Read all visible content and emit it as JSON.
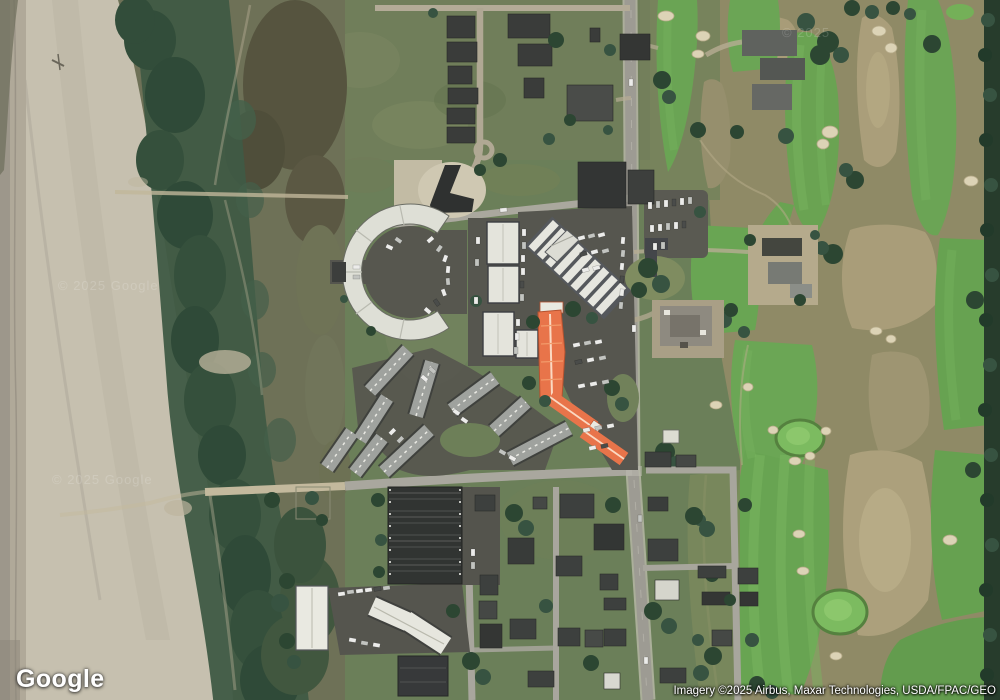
{
  "page": {
    "kind": "satellite map viewport",
    "width_px": 1000,
    "height_px": 700
  },
  "branding": {
    "logo_text": "Google"
  },
  "attribution": {
    "text": "Imagery ©2025 Airbus, Maxar Technologies, USDA/FPAC/GEO"
  },
  "watermarks": {
    "beach_upper": "© 2025 Google",
    "beach_lower": "© 2025 Google",
    "golf": "© 2025"
  },
  "map": {
    "view_type": "satellite imagery, top-down",
    "scene_summary": "Coastal resort strip: ocean beach and vegetated dunes on the west, a small town with condo buildings, motels, storage and parking lots in the center along a north-south main road, and a links golf course with fairways, sand bunkers, waste areas and a conifer tree line on the east. Three condominium wings near the main road are highlighted orange.",
    "regions": [
      {
        "id": "wet-shoreline",
        "label": "wet sand / tide line",
        "color": "#a89f90"
      },
      {
        "id": "beach",
        "label": "sandy ocean beach",
        "color": "#c6bfae"
      },
      {
        "id": "dune-vegetation",
        "label": "dark dune scrub band",
        "color": "#3f5a45"
      },
      {
        "id": "dune-field",
        "label": "olive-brown back dunes",
        "color": "#6e7157"
      },
      {
        "id": "town-grass",
        "label": "town grass and scrub",
        "color": "#6b7f59"
      },
      {
        "id": "golf-fairways",
        "label": "golf course fairways",
        "color": "#68a452"
      },
      {
        "id": "golf-waste",
        "label": "sandy waste areas",
        "color": "#aba07c"
      },
      {
        "id": "tree-line",
        "label": "conifer tree line on east edge",
        "color": "#273c2c"
      }
    ],
    "highlighted_buildings": {
      "color": "#e8744a",
      "count": 3,
      "label": "orange-highlighted condo building wings near the main road"
    },
    "notable_features": [
      "semicircular building with inner parking court",
      "row of white-roofed condo blocks",
      "diagonal building with striped white roof bays",
      "self-storage building with dark parallel roof rows",
      "motel with white roofs and parking",
      "parking lots with parked cars",
      "residential grid of small dark-roofed houses",
      "sand bunkers and putting greens on the golf course"
    ]
  }
}
